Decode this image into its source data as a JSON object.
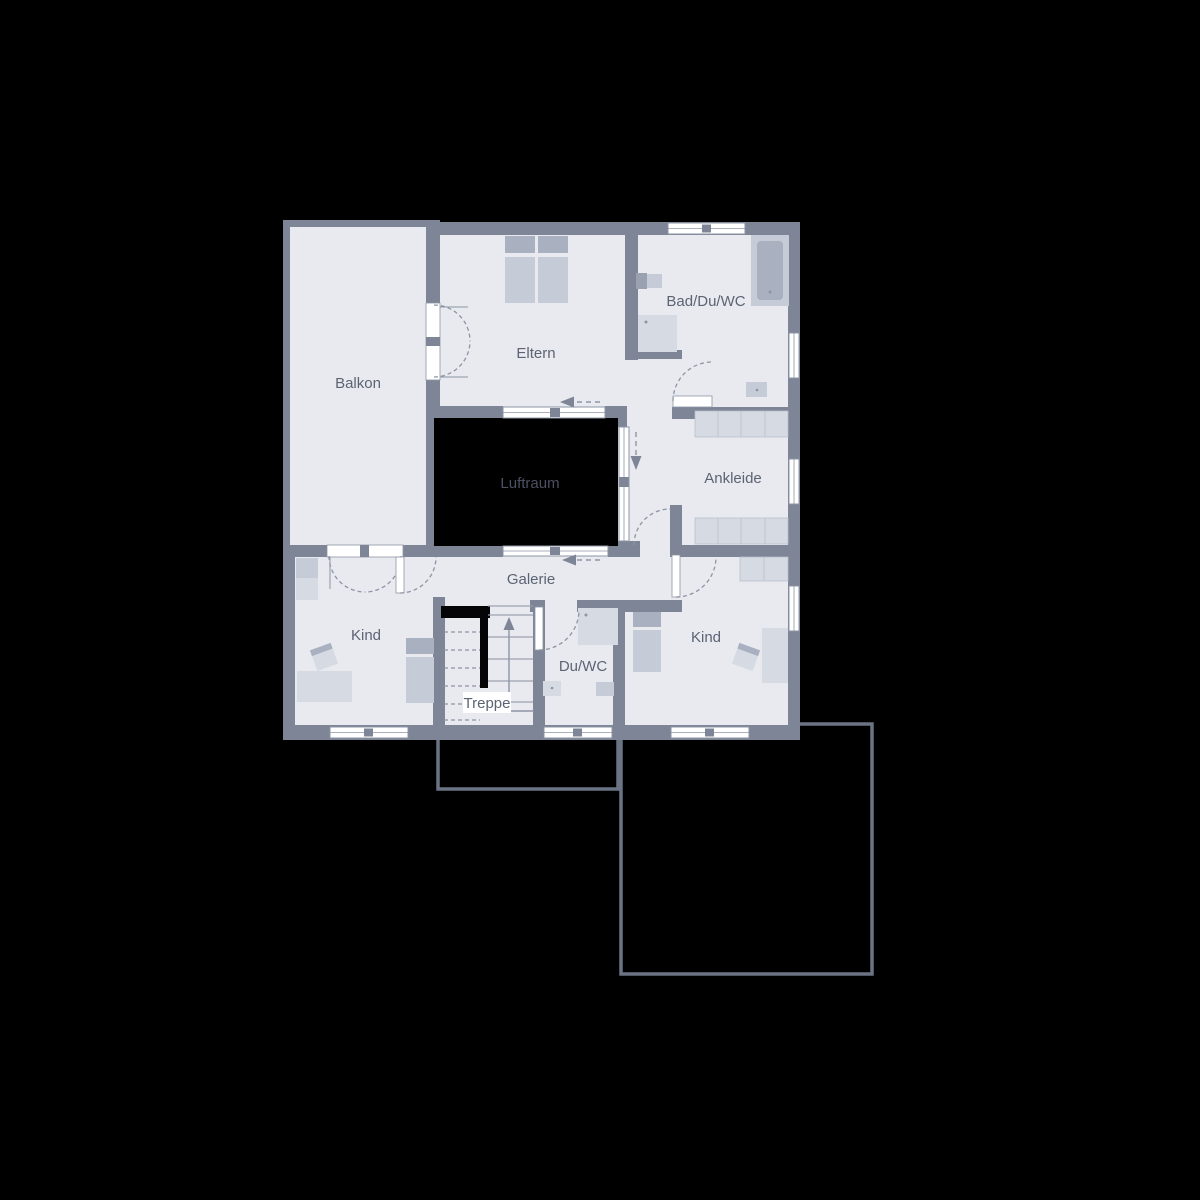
{
  "figure_type": "floor-plan-upper-storey",
  "palette": {
    "background": "#000000",
    "wall": "#7d8596",
    "floor": "#e8eaf0",
    "void": "#000000",
    "window": "#ffffff",
    "frame": "#8d95a4",
    "dashed": "#8d95a4",
    "furn_light": "#d6dbe3",
    "furn_mid": "#c5cbd7",
    "furn_dark": "#a9b0c0",
    "label": "#5c6372",
    "void_label": "#4a5160",
    "outline": "#6b7484",
    "stair_line": "#9aa2b1"
  },
  "rooms": {
    "balkon": {
      "label": "Balkon"
    },
    "eltern": {
      "label": "Eltern"
    },
    "bad": {
      "label": "Bad/Du/WC"
    },
    "ankleide": {
      "label": "Ankleide"
    },
    "luftraum": {
      "label": "Luftraum"
    },
    "galerie": {
      "label": "Galerie"
    },
    "kind_left": {
      "label": "Kind"
    },
    "kind_right": {
      "label": "Kind"
    },
    "duwc": {
      "label": "Du/WC"
    },
    "treppe": {
      "label": "Treppe"
    }
  }
}
